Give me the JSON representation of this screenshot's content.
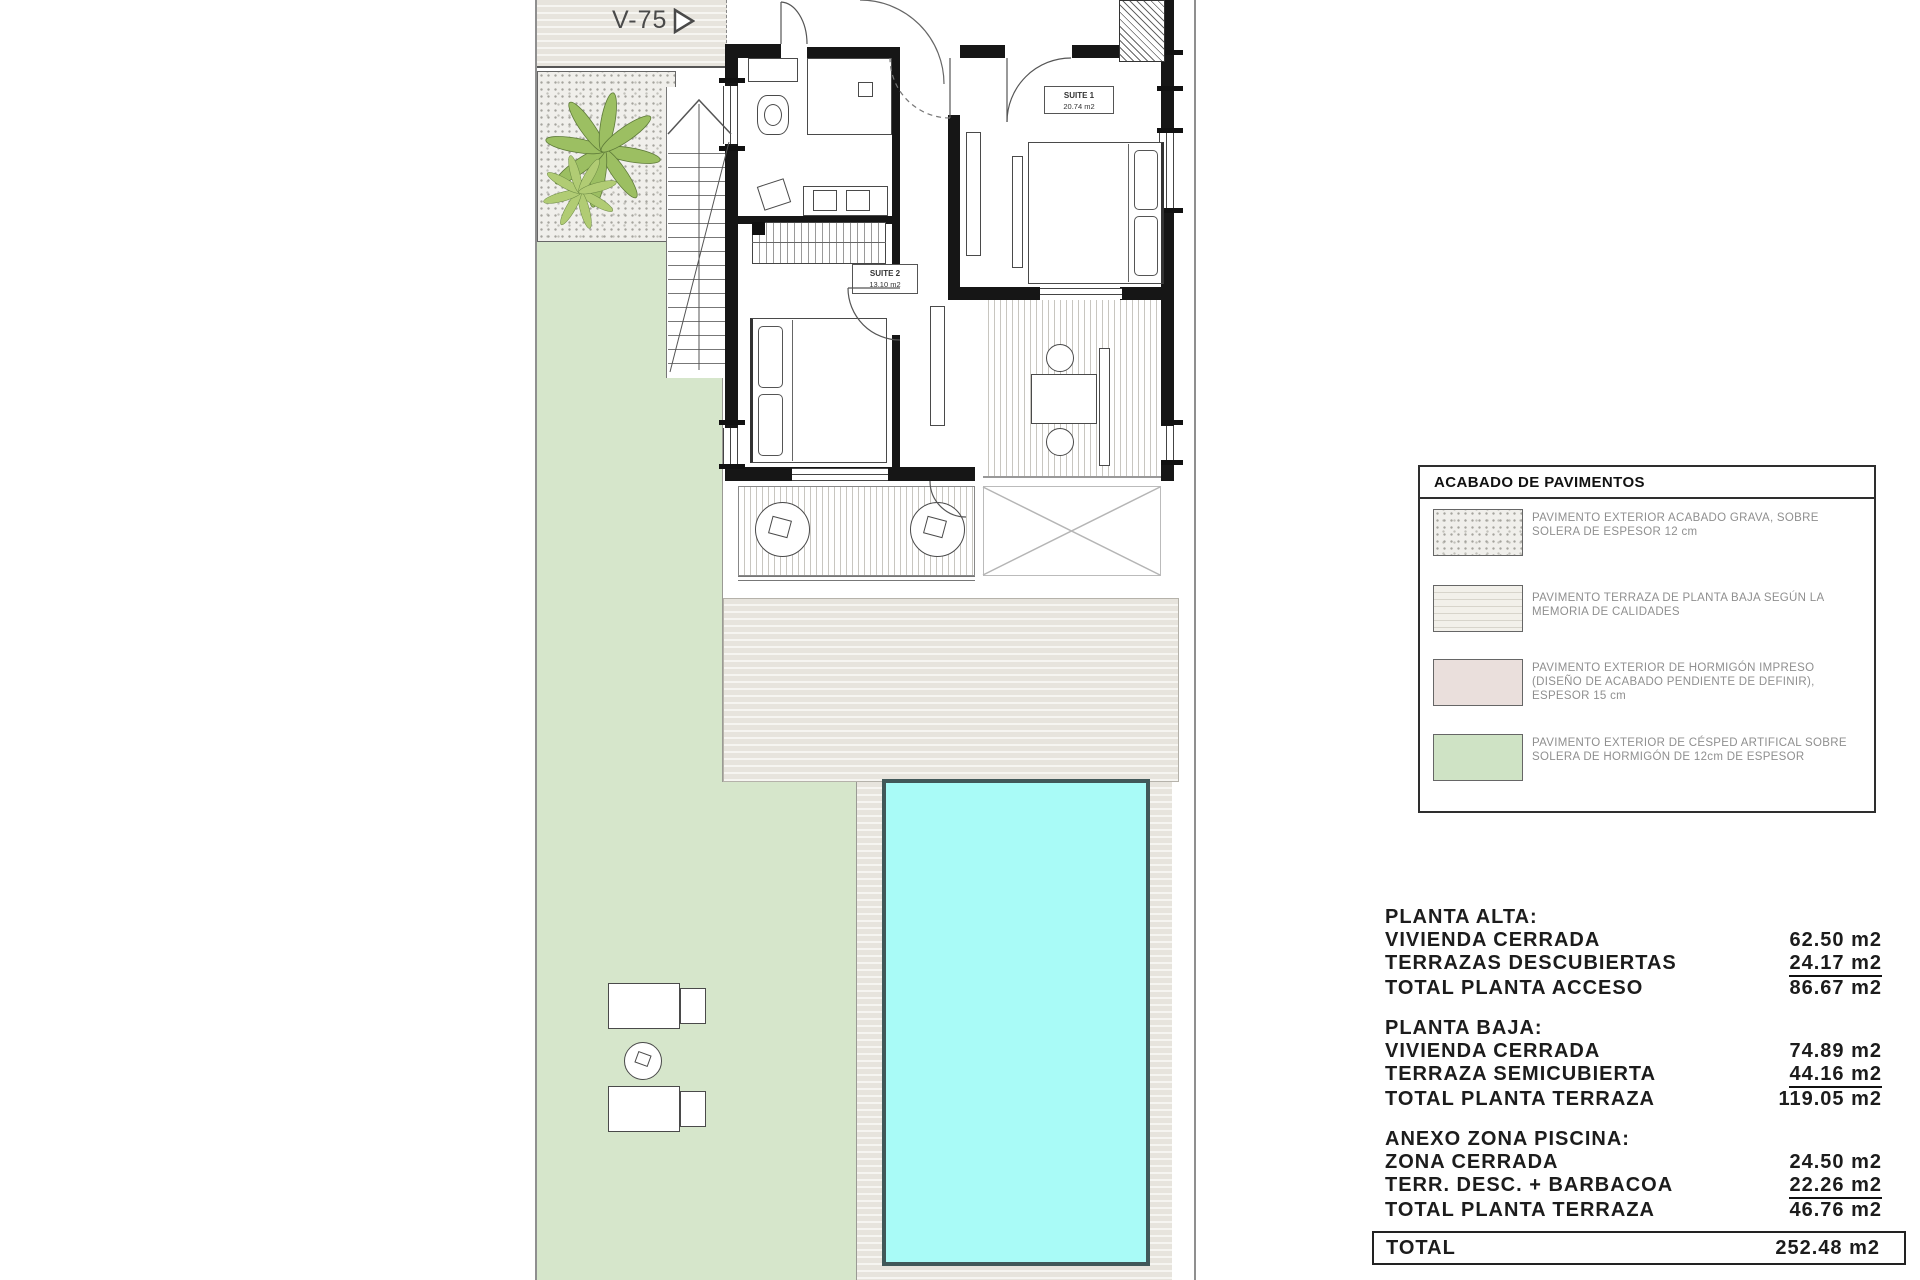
{
  "plan": {
    "terrace_label": "V-75",
    "rooms": {
      "suite1": {
        "name": "SUITE 1",
        "area": "20.74 m2"
      },
      "suite2": {
        "name": "SUITE 2",
        "area": "13.10 m2"
      }
    }
  },
  "legend": {
    "title": "ACABADO DE PAVIMENTOS",
    "items": [
      {
        "swatch": "gravel",
        "text": "PAVIMENTO EXTERIOR ACABADO GRAVA, SOBRE SOLERA DE ESPESOR 12 cm"
      },
      {
        "swatch": "terrace",
        "text": "PAVIMENTO TERRAZA DE PLANTA BAJA SEGÚN LA MEMORIA DE CALIDADES"
      },
      {
        "swatch": "concrete",
        "text": "PAVIMENTO EXTERIOR DE HORMIGÓN IMPRESO (DISEÑO DE ACABADO PENDIENTE DE DEFINIR), ESPESOR 15 cm"
      },
      {
        "swatch": "grass",
        "text": "PAVIMENTO EXTERIOR DE CÉSPED ARTIFICAL SOBRE SOLERA DE HORMIGÓN DE 12cm DE ESPESOR"
      }
    ]
  },
  "areas": {
    "sections": [
      {
        "title": "PLANTA ALTA:",
        "rows": [
          {
            "label": "VIVIENDA CERRADA",
            "value": "62.50 m2"
          },
          {
            "label": "TERRAZAS DESCUBIERTAS",
            "value": "24.17 m2"
          },
          {
            "label": "TOTAL PLANTA ACCESO",
            "value": "86.67 m2"
          }
        ]
      },
      {
        "title": "PLANTA BAJA:",
        "rows": [
          {
            "label": "VIVIENDA CERRADA",
            "value": "74.89 m2"
          },
          {
            "label": "TERRAZA SEMICUBIERTA",
            "value": "44.16 m2"
          },
          {
            "label": "TOTAL PLANTA TERRAZA",
            "value": "119.05 m2"
          }
        ]
      },
      {
        "title": "ANEXO ZONA PISCINA:",
        "rows": [
          {
            "label": "ZONA CERRADA",
            "value": "24.50 m2"
          },
          {
            "label": "TERR. DESC. + BARBACOA",
            "value": "22.26 m2"
          },
          {
            "label": "TOTAL PLANTA TERRAZA",
            "value": "46.76 m2"
          }
        ]
      }
    ],
    "total": {
      "label": "TOTAL",
      "value": "252.48 m2"
    }
  },
  "colors": {
    "pool": "#a9fbf7",
    "pool_border": "#415859",
    "grass": "#d6e6cb",
    "legend_grass": "#cfe3c5",
    "concrete": "#eadfdc",
    "terrace_base": "#e7e4dd",
    "wall": "#161616"
  }
}
